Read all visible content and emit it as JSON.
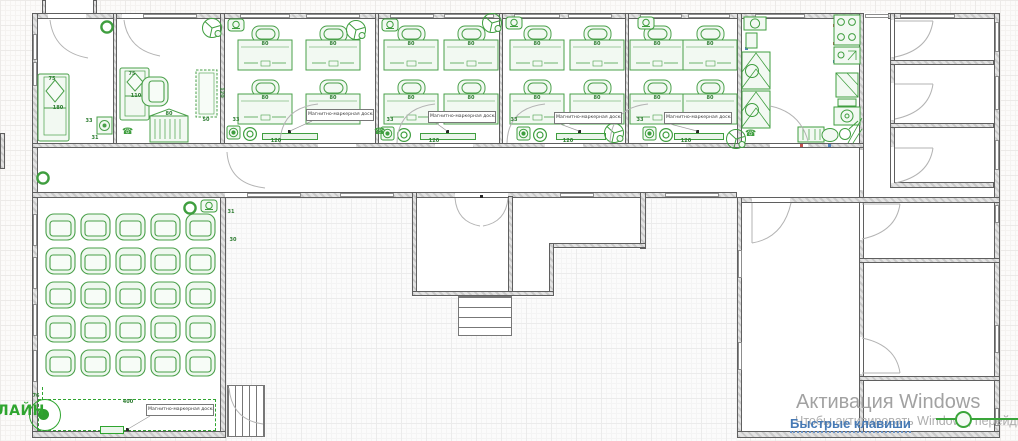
{
  "watermark": {
    "line1": "Активация Windows",
    "line2": "Чтобы активировать Windows, перейдите в раздел \"Параметры\"."
  },
  "hint_link": {
    "label": "Быстрые клавиши"
  },
  "logo": {
    "text": "ЛАЙН"
  },
  "board": {
    "label": "Магнитно-маркерная доска",
    "length_classroom": "120",
    "length_hall": "400",
    "pin_offset": "76"
  },
  "dims": {
    "desk_width": "80",
    "wall_gap": "33",
    "gap_31": "31",
    "gap_30": "30",
    "sofa_width": "75",
    "sofa_a_length": "180",
    "sofa_b_length": "110",
    "table_length": "120",
    "table_width": "50",
    "wardrobe_width": "80"
  },
  "icons": {
    "camera": "security-camera",
    "pinwheel": "ceiling-fan",
    "donut": "vent-fan",
    "extinguisher": "fire-extinguisher",
    "phone": "telephone"
  },
  "colors": {
    "accent_green": "#2fa52f",
    "furniture_green": "#4aa04a",
    "link_blue": "#4679b4",
    "watermark_gray": "#a2a2a2",
    "wall_fill": "#dcdcdc"
  }
}
